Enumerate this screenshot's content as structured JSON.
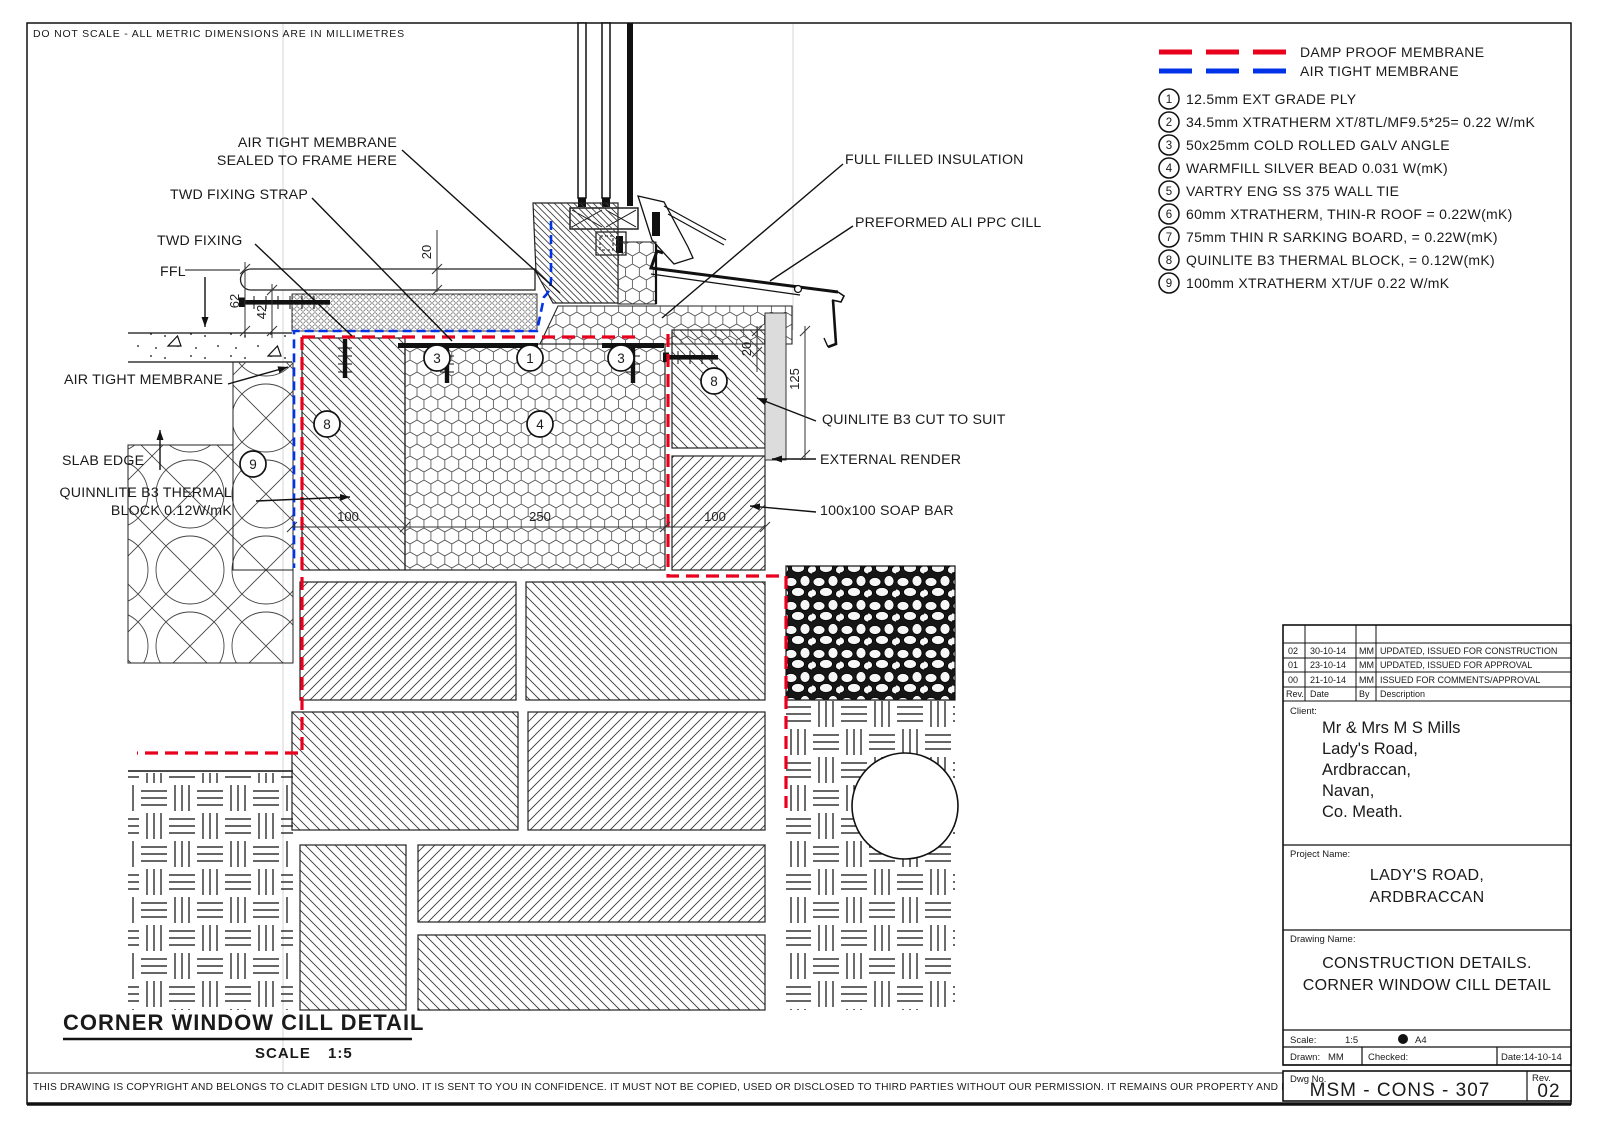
{
  "sheet": {
    "top_note": "DO NOT SCALE - ALL METRIC DIMENSIONS ARE IN MILLIMETRES",
    "footer": "THIS DRAWING IS COPYRIGHT AND BELONGS TO CLADIT DESIGN LTD UNO. IT IS SENT TO YOU IN CONFIDENCE. IT MUST NOT BE COPIED, USED OR DISCLOSED TO THIRD PARTIES WITHOUT OUR PERMISSION. IT REMAINS OUR PROPERTY AND MUST BE RETURNED ON REQUEST."
  },
  "legend": {
    "damp_proof": {
      "label": "DAMP PROOF MEMBRANE",
      "color": "#e8001d"
    },
    "air_tight": {
      "label": "AIR TIGHT MEMBRANE",
      "color": "#0033e8"
    },
    "items": [
      {
        "num": "1",
        "text": "12.5mm EXT GRADE PLY"
      },
      {
        "num": "2",
        "text": "34.5mm XTRATHERM XT/8TL/MF9.5*25= 0.22 W/mK"
      },
      {
        "num": "3",
        "text": "50x25mm COLD ROLLED GALV ANGLE"
      },
      {
        "num": "4",
        "text": "WARMFILL SILVER BEAD 0.031 W(mK)"
      },
      {
        "num": "5",
        "text": "VARTRY ENG SS 375 WALL TIE"
      },
      {
        "num": "6",
        "text": "60mm XTRATHERM, THIN-R ROOF = 0.22W(mK)"
      },
      {
        "num": "7",
        "text": "75mm THIN R SARKING BOARD, = 0.22W(mK)"
      },
      {
        "num": "8",
        "text": "QUINLITE B3 THERMAL BLOCK, = 0.12W(mK)"
      },
      {
        "num": "9",
        "text": "100mm XTRATHERM XT/UF 0.22 W/mK"
      }
    ]
  },
  "drawing": {
    "view_title": "CORNER WINDOW CILL DETAIL",
    "scale_label": "SCALE",
    "scale_value": "1:5",
    "labels": {
      "atm_sealed_1": "AIR TIGHT MEMBRANE",
      "atm_sealed_2": "SEALED TO FRAME HERE",
      "twd_fixing_strap": "TWD FIXING STRAP",
      "twd_fixing": "TWD FIXING",
      "ffl": "FFL",
      "full_filled_insulation": "FULL FILLED INSULATION",
      "preformed_cill": "PREFORMED ALI PPC CILL",
      "air_tight_membrane": "AIR TIGHT MEMBRANE",
      "slab_edge": "SLAB EDGE",
      "quinnlite_1": "QUINNLITE B3 THERMAL",
      "quinnlite_2": "BLOCK 0.12W/mK",
      "quinlite_cut": "QUINLITE B3 CUT TO SUIT",
      "external_render": "EXTERNAL RENDER",
      "soap_bar": "100x100 SOAP BAR"
    },
    "dimensions": {
      "board": "20",
      "d62": "62",
      "d42": "42",
      "render": "20",
      "d125": "125",
      "w_left": "100",
      "w_mid": "250",
      "w_right": "100"
    },
    "callouts": [
      "3",
      "1",
      "3",
      "8",
      "4",
      "8",
      "9"
    ]
  },
  "title_block": {
    "revisions": {
      "headers": {
        "rev": "Rev.",
        "date": "Date",
        "by": "By",
        "description": "Description"
      },
      "rows": [
        {
          "rev": "02",
          "date": "30-10-14",
          "by": "MM",
          "description": "UPDATED, ISSUED FOR CONSTRUCTION"
        },
        {
          "rev": "01",
          "date": "23-10-14",
          "by": "MM",
          "description": "UPDATED, ISSUED FOR APPROVAL"
        },
        {
          "rev": "00",
          "date": "21-10-14",
          "by": "MM",
          "description": "ISSUED FOR COMMENTS/APPROVAL"
        }
      ]
    },
    "client": {
      "label": "Client:",
      "line1": "Mr & Mrs M S Mills",
      "line2": "Lady's Road,",
      "line3": "Ardbraccan,",
      "line4": "Navan,",
      "line5": "Co. Meath."
    },
    "project": {
      "label": "Project Name:",
      "line1": "LADY'S ROAD,",
      "line2": "ARDBRACCAN"
    },
    "drawing_name": {
      "label": "Drawing Name:",
      "line1": "CONSTRUCTION DETAILS.",
      "line2": "CORNER WINDOW CILL DETAIL"
    },
    "scale_row": {
      "label": "Scale:",
      "value": "1:5",
      "paper": "A4"
    },
    "drawn_row": {
      "drawn_label": "Drawn:",
      "drawn": "MM",
      "checked_label": "Checked:",
      "date": "Date:14-10-14"
    },
    "dwg_row": {
      "label": "Dwg No.",
      "number": "MSM - CONS - 307",
      "rev_label": "Rev.",
      "rev": "02"
    }
  }
}
